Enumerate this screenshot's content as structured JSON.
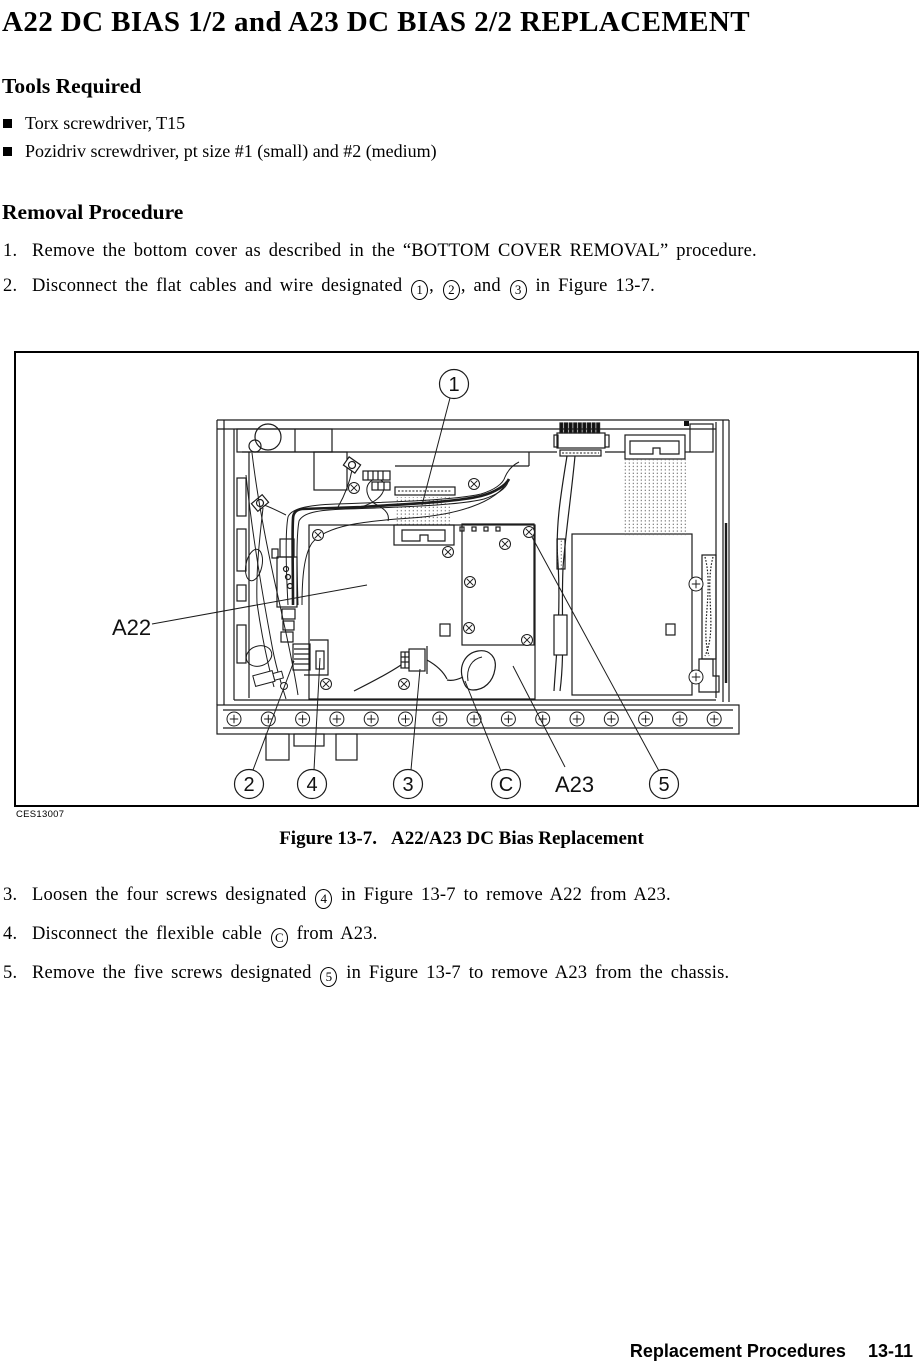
{
  "page": {
    "title": "A22 DC BIAS 1/2 and A23 DC BIAS 2/2 REPLACEMENT",
    "footer": {
      "section": "Replacement Procedures",
      "page_number": "13-11"
    }
  },
  "tools": {
    "heading": "Tools Required",
    "items": [
      "Torx screwdriver, T15",
      "Pozidriv screwdriver, pt size #1 (small) and #2 (medium)"
    ]
  },
  "removal": {
    "heading": "Removal Procedure",
    "steps_before_figure": [
      {
        "num": "1.",
        "text": "Remove the bottom cover as described in the “BOTTOM COVER REMOVAL” procedure."
      },
      {
        "num": "2.",
        "text": "Disconnect the flat cables and wire designated {1}, {2}, and {3} in Figure 13-7."
      }
    ],
    "steps_after_figure": [
      {
        "num": "3.",
        "text": "Loosen the four screws designated {4} in Figure 13-7 to remove A22 from A23."
      },
      {
        "num": "4.",
        "text": "Disconnect the flexible cable {C} from A23."
      },
      {
        "num": "5.",
        "text": "Remove the five screws designated {5} in Figure 13-7 to remove A23 from the chassis."
      }
    ]
  },
  "figure": {
    "image_code": "CES13007",
    "caption_label": "Figure 13-7.",
    "caption_title": "A22/A23 DC Bias Replacement",
    "callouts": [
      {
        "label": "1",
        "cx": 438,
        "cy": 31,
        "lx1": 434,
        "ly1": 45,
        "lx2": 406,
        "ly2": 152
      },
      {
        "label": "2",
        "cx": 233,
        "cy": 431,
        "lx1": 237,
        "ly1": 417,
        "lx2": 278,
        "ly2": 308
      },
      {
        "label": "4",
        "cx": 296,
        "cy": 431,
        "lx1": 298,
        "ly1": 417,
        "lx2": 304,
        "ly2": 305
      },
      {
        "label": "3",
        "cx": 392,
        "cy": 431,
        "lx1": 395,
        "ly1": 417,
        "lx2": 404,
        "ly2": 316
      },
      {
        "label": "C",
        "cx": 490,
        "cy": 431,
        "lx1": 485,
        "ly1": 418,
        "lx2": 449,
        "ly2": 328
      },
      {
        "label": "5",
        "cx": 648,
        "cy": 431,
        "lx1": 643,
        "ly1": 418,
        "lx2": 516,
        "ly2": 184
      }
    ],
    "part_labels": [
      {
        "label": "A22",
        "x": 96,
        "y": 282,
        "lx1": 136,
        "ly1": 271,
        "lx2": 351,
        "ly2": 232
      },
      {
        "label": "A23",
        "x": 539,
        "y": 439,
        "lx1": 549,
        "ly1": 414,
        "lx2": 497,
        "ly2": 313
      }
    ]
  }
}
